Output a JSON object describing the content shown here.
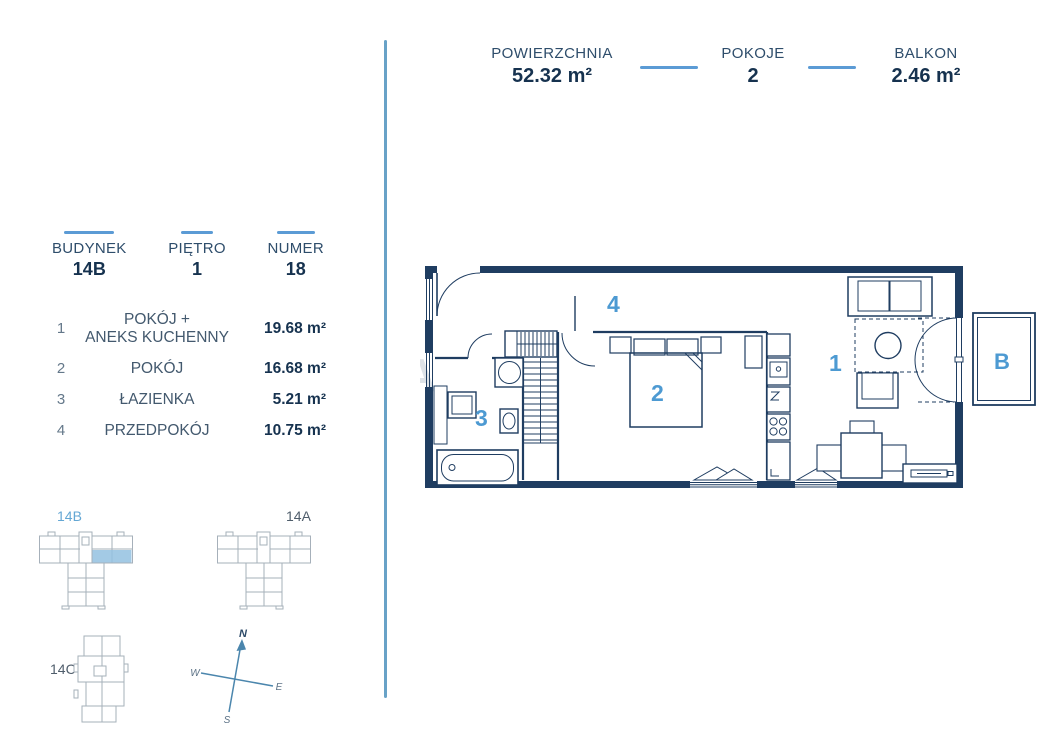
{
  "header": {
    "stats": [
      {
        "label": "POWIERZCHNIA",
        "value": "52.32 m²"
      },
      {
        "label": "POKOJE",
        "value": "2"
      },
      {
        "label": "BALKON",
        "value": "2.46 m²"
      }
    ]
  },
  "unit_info": {
    "items": [
      {
        "label": "BUDYNEK",
        "value": "14B"
      },
      {
        "label": "PIĘTRO",
        "value": "1"
      },
      {
        "label": "NUMER",
        "value": "18"
      }
    ]
  },
  "rooms": [
    {
      "num": "1",
      "name": "POKÓJ +\nANEKS KUCHENNY",
      "area": "19.68 m²"
    },
    {
      "num": "2",
      "name": "POKÓJ",
      "area": "16.68 m²"
    },
    {
      "num": "3",
      "name": "ŁAZIENKA",
      "area": "5.21 m²"
    },
    {
      "num": "4",
      "name": "PRZEDPOKÓJ",
      "area": "10.75 m²"
    }
  ],
  "site_maps": {
    "b": {
      "label": "14B",
      "highlighted": true
    },
    "a": {
      "label": "14A",
      "highlighted": false
    },
    "c": {
      "label": "14C",
      "highlighted": false
    }
  },
  "compass": {
    "n": "N",
    "w": "W",
    "e": "E",
    "s": "S"
  },
  "plan": {
    "labels": {
      "living": "1",
      "bedroom": "2",
      "bathroom": "3",
      "hall": "4",
      "balcony": "B"
    },
    "watermark": "A"
  },
  "colors": {
    "wall_navy": "#1f3d61",
    "text_dark": "#16324f",
    "label_navy": "#2e4d6b",
    "accent_blue": "#5b9bd5",
    "room_number_blue": "#4d9ad2",
    "divider_blue": "#68a2c7",
    "map_outline_gray": "#a6b0ba",
    "highlight_fill": "#93c1e1"
  }
}
